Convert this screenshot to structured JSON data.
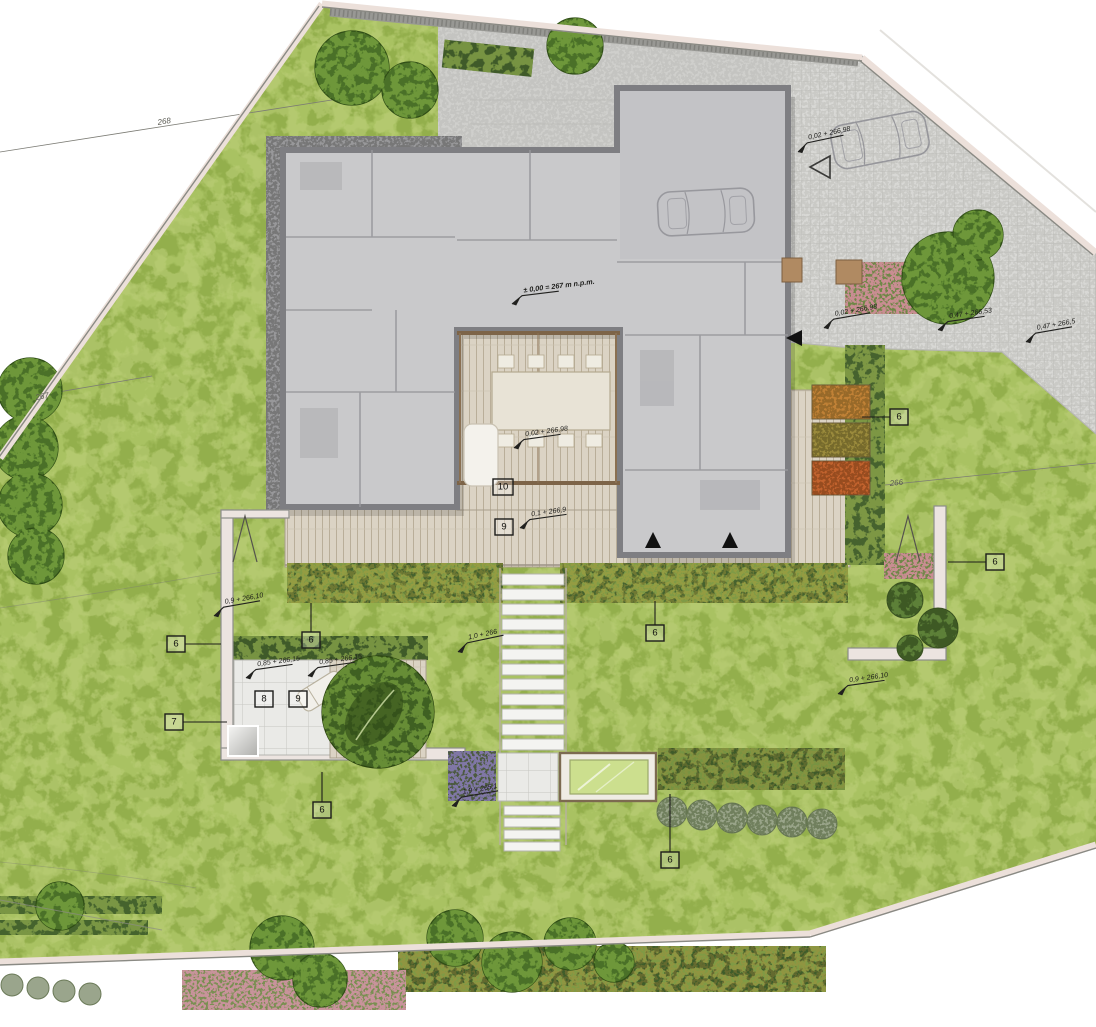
{
  "plan": {
    "datum": "± 0,00 = 267 m n.p.m.",
    "spots": [
      "0,02 + 266,98",
      "0,02 + 266,98",
      "0,47 + 266,53",
      "0,47 + 266,5",
      "0,02 + 266,98",
      "0,1 + 266,9",
      "1,0 + 266",
      "1,9 + 265,1",
      "0,9 + 266,10",
      "0,85 + 266,15",
      "0,85 + 266,15",
      "0,9 + 266,10"
    ],
    "markers": [
      "6",
      "6",
      "6",
      "6",
      "6",
      "7",
      "8",
      "9",
      "9",
      "10",
      "6",
      "6"
    ],
    "contours": [
      "268",
      "267",
      "266"
    ],
    "colors": {
      "lawn": "#a9c262",
      "house_fill": "#c9c9cb",
      "house_wall": "#7e7e82",
      "deck_wood": "#dbd3c4",
      "paving": "#d8d8d5",
      "hedge_dark": "#46622e",
      "tree_green": "#4a7028",
      "flower_pink": "#d694a8",
      "planter_orange": "#c08136",
      "pergola_brown": "#7d6448",
      "water_glass": "#ccdf8e"
    }
  }
}
